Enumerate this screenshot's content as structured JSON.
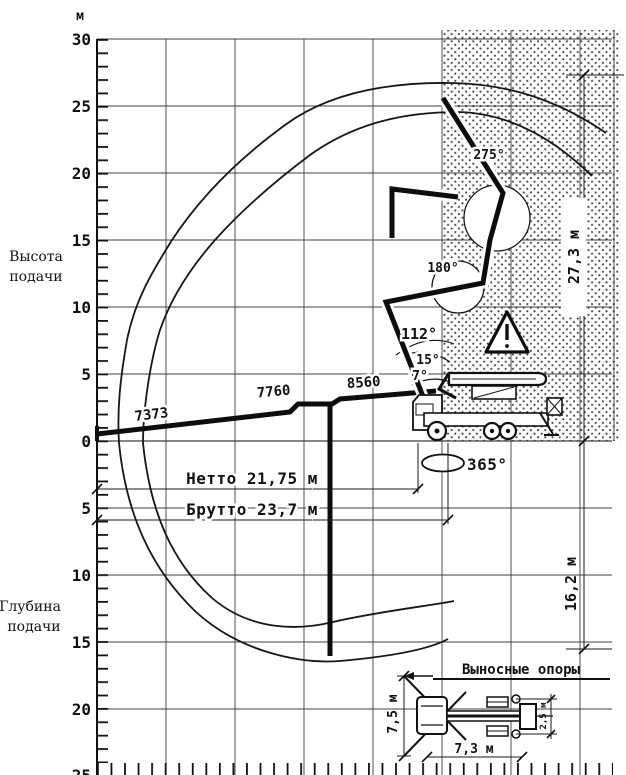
{
  "y_axis": {
    "unit_label": "м",
    "height_ticks": [
      "30",
      "25",
      "20",
      "15",
      "10",
      "5",
      "0"
    ],
    "depth_ticks": [
      "5",
      "10",
      "15",
      "20",
      "25"
    ],
    "height_label_line1": "Высота",
    "height_label_line2": "подачи",
    "depth_label_line1": "Глубина",
    "depth_label_line2": "подачи"
  },
  "boom_sections": {
    "section1": "7373",
    "section2": "7760",
    "section3": "8560"
  },
  "angles": {
    "tip_joint": "275°",
    "mid_joint": "180°",
    "main_boom": "112°",
    "boom_min": "15°",
    "boom_ground": "7°",
    "slewing": "365°"
  },
  "dimensions": {
    "net_reach": "Нетто 21,75 м",
    "gross_reach": "Брутто 23,7 м",
    "max_height": "27,3 м",
    "max_depth": "16,2 м"
  },
  "outrigger_inset": {
    "title": "Выносные опоры",
    "front_spread": "7,5 м",
    "base_length": "7,3 м",
    "rear_spread": "2,5 м"
  }
}
